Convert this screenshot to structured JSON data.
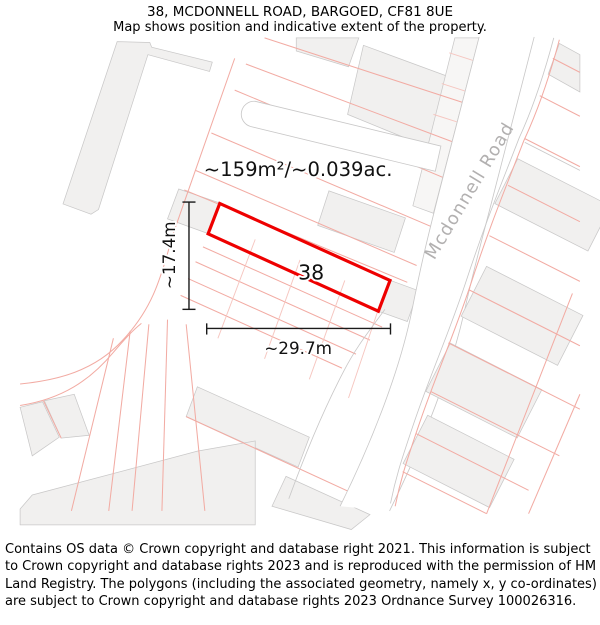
{
  "header": {
    "title": "38, MCDONNELL ROAD, BARGOED, CF81 8UE",
    "subtitle": "Map shows position and indicative extent of the property."
  },
  "map": {
    "area_label": "~159m²/~0.039ac.",
    "plot_number": "38",
    "height_label": "~17.4m",
    "width_label": "~29.7m",
    "road_name": "Mcdonnell Road",
    "colors": {
      "plot_outline": "#ee0000",
      "parcel_line": "#f2aba3",
      "building_fill": "#f1f0ef",
      "building_stroke": "#c9c8c8",
      "road_label_text": "#b2b0b0",
      "dimension_line": "#1a1a1a"
    }
  },
  "footer": {
    "text": "Contains OS data © Crown copyright and database right 2021. This information is subject to Crown copyright and database rights 2023 and is reproduced with the permission of HM Land Registry. The polygons (including the associated geometry, namely x, y co-ordinates) are subject to Crown copyright and database rights 2023 Ordnance Survey 100026316."
  }
}
